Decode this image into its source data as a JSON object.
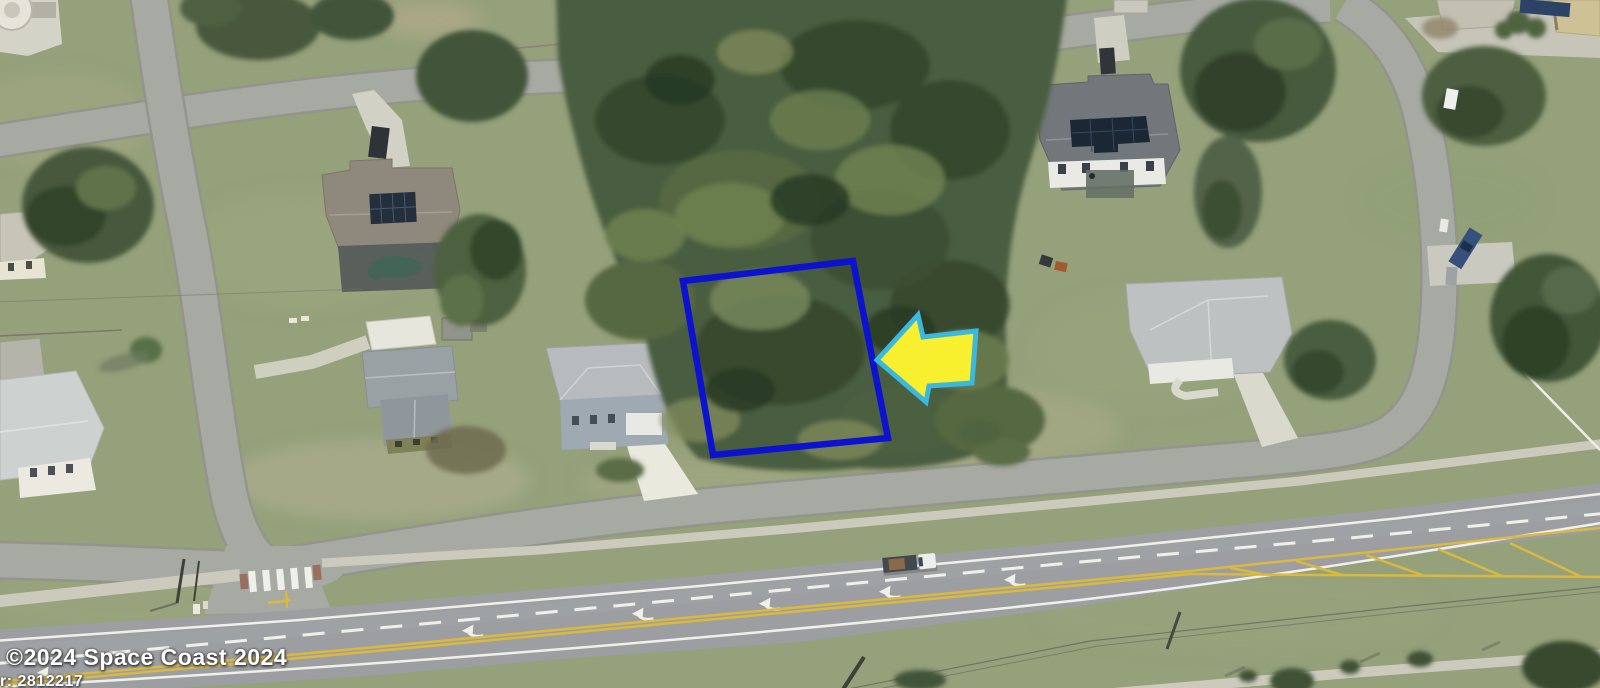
{
  "watermark": {
    "copyright": "©2024 Space Coast 2024",
    "reference_partial": "r: 2812217"
  },
  "annotations": {
    "parcel_boundary": {
      "color": "#0d11d0"
    },
    "pointer_arrow": {
      "fill": "#f8ef2e",
      "border": "#3bb8de"
    }
  },
  "palette": {
    "grass": "#95a17b",
    "forest": "#4a5d3f",
    "road_asphalt": "#a7a9a3",
    "highway_asphalt": "#9c9ea1",
    "concrete": "#cbcabd",
    "lane_marking_white": "#f0f0ea",
    "lane_marking_yellow": "#d9b93f"
  }
}
